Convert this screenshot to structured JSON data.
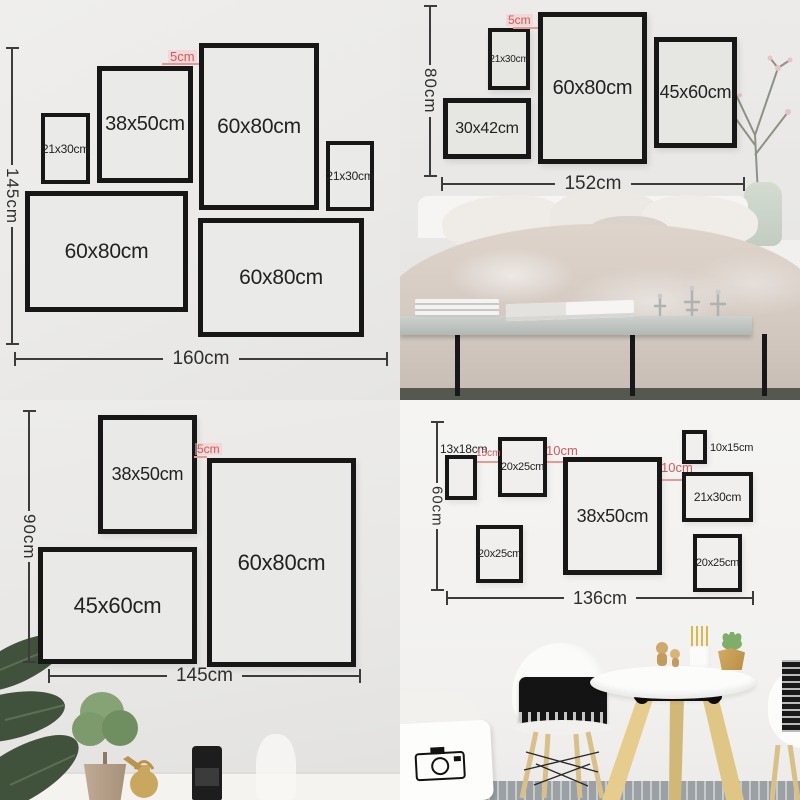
{
  "quadrants": [
    {
      "name": "gallery-layout-160cm",
      "v_dim": "145cm",
      "h_dim": "160cm",
      "frames": [
        {
          "label": "21x30cm",
          "x": 41,
          "y": 113,
          "w": 49,
          "h": 71,
          "fs": 12,
          "bw": 4
        },
        {
          "label": "38x50cm",
          "x": 97,
          "y": 66,
          "w": 96,
          "h": 117,
          "fs": 20,
          "bw": 5
        },
        {
          "label": "60x80cm",
          "x": 199,
          "y": 43,
          "w": 120,
          "h": 167,
          "fs": 21,
          "bw": 5
        },
        {
          "label": "21x30cm",
          "x": 326,
          "y": 141,
          "w": 48,
          "h": 70,
          "fs": 12,
          "bw": 4
        },
        {
          "label": "60x80cm",
          "x": 25,
          "y": 191,
          "w": 163,
          "h": 121,
          "fs": 21,
          "bw": 5
        },
        {
          "label": "60x80cm",
          "x": 198,
          "y": 218,
          "w": 166,
          "h": 119,
          "fs": 21,
          "bw": 5
        }
      ],
      "gaps": [
        {
          "label": "5cm",
          "tx": 168,
          "ty": 50,
          "fs": 13,
          "hl": 1,
          "lx": 162,
          "ly": 63,
          "lw": 37
        }
      ]
    },
    {
      "name": "gallery-layout-152cm-bedroom",
      "v_dim": "80cm",
      "h_dim": "152cm",
      "frames": [
        {
          "label": "21x30cm",
          "x": 88,
          "y": 28,
          "w": 42,
          "h": 62,
          "fs": 10,
          "bw": 4
        },
        {
          "label": "60x80cm",
          "x": 138,
          "y": 12,
          "w": 109,
          "h": 152,
          "fs": 20,
          "bw": 5
        },
        {
          "label": "45x60cm",
          "x": 254,
          "y": 37,
          "w": 83,
          "h": 111,
          "fs": 18,
          "bw": 5
        },
        {
          "label": "30x42cm",
          "x": 43,
          "y": 98,
          "w": 88,
          "h": 61,
          "fs": 16,
          "bw": 5
        }
      ],
      "gaps": [
        {
          "label": "5cm",
          "tx": 106,
          "ty": 14,
          "fs": 12,
          "hl": 1,
          "lx": 113,
          "ly": 27,
          "lw": 25
        }
      ]
    },
    {
      "name": "gallery-layout-145cm",
      "v_dim": "90cm",
      "h_dim": "145cm",
      "frames": [
        {
          "label": "38x50cm",
          "x": 98,
          "y": 15,
          "w": 99,
          "h": 119,
          "fs": 18,
          "bw": 5
        },
        {
          "label": "60x80cm",
          "x": 207,
          "y": 58,
          "w": 149,
          "h": 209,
          "fs": 22,
          "bw": 5
        },
        {
          "label": "45x60cm",
          "x": 38,
          "y": 147,
          "w": 159,
          "h": 117,
          "fs": 22,
          "bw": 5
        }
      ],
      "gaps": [
        {
          "label": "5cm",
          "tx": 195,
          "ty": 43,
          "fs": 12,
          "hl": 1,
          "lx": 194,
          "ly": 56,
          "lw": 13
        }
      ]
    },
    {
      "name": "gallery-layout-136cm-dining",
      "v_dim": "60cm",
      "h_dim": "136cm",
      "frames": [
        {
          "label": "13x18cm",
          "x": 45,
          "y": 55,
          "w": 32,
          "h": 45,
          "fs": 12,
          "bw": 4,
          "lp": "above"
        },
        {
          "label": "20x25cm",
          "x": 98,
          "y": 37,
          "w": 49,
          "h": 60,
          "fs": 11,
          "bw": 4
        },
        {
          "label": "38x50cm",
          "x": 163,
          "y": 57,
          "w": 99,
          "h": 118,
          "fs": 18,
          "bw": 5
        },
        {
          "label": "10x15cm",
          "x": 282,
          "y": 30,
          "w": 25,
          "h": 34,
          "fs": 11,
          "bw": 4,
          "lp": "right"
        },
        {
          "label": "21x30cm",
          "x": 282,
          "y": 72,
          "w": 71,
          "h": 50,
          "fs": 12,
          "bw": 4
        },
        {
          "label": "20x25cm",
          "x": 76,
          "y": 125,
          "w": 47,
          "h": 58,
          "fs": 11,
          "bw": 4
        },
        {
          "label": "20x25cm",
          "x": 293,
          "y": 134,
          "w": 49,
          "h": 58,
          "fs": 11,
          "bw": 4
        }
      ],
      "gaps": [
        {
          "label": "15cm",
          "tx": 76,
          "ty": 49,
          "fs": 10,
          "lx": 77,
          "ly": 61,
          "lw": 21
        },
        {
          "label": "10cm",
          "tx": 146,
          "ty": 44,
          "fs": 13,
          "lx": 147,
          "ly": 61,
          "lw": 16
        },
        {
          "label": "10cm",
          "tx": 261,
          "ty": 61,
          "fs": 13,
          "lx": 262,
          "ly": 79,
          "lw": 20
        }
      ]
    }
  ],
  "colors": {
    "frame_border": "#171717",
    "dimension_line": "#3c3c3c",
    "gap_red": "#cf5c5c",
    "gap_line_pink": "#e59a9a"
  }
}
